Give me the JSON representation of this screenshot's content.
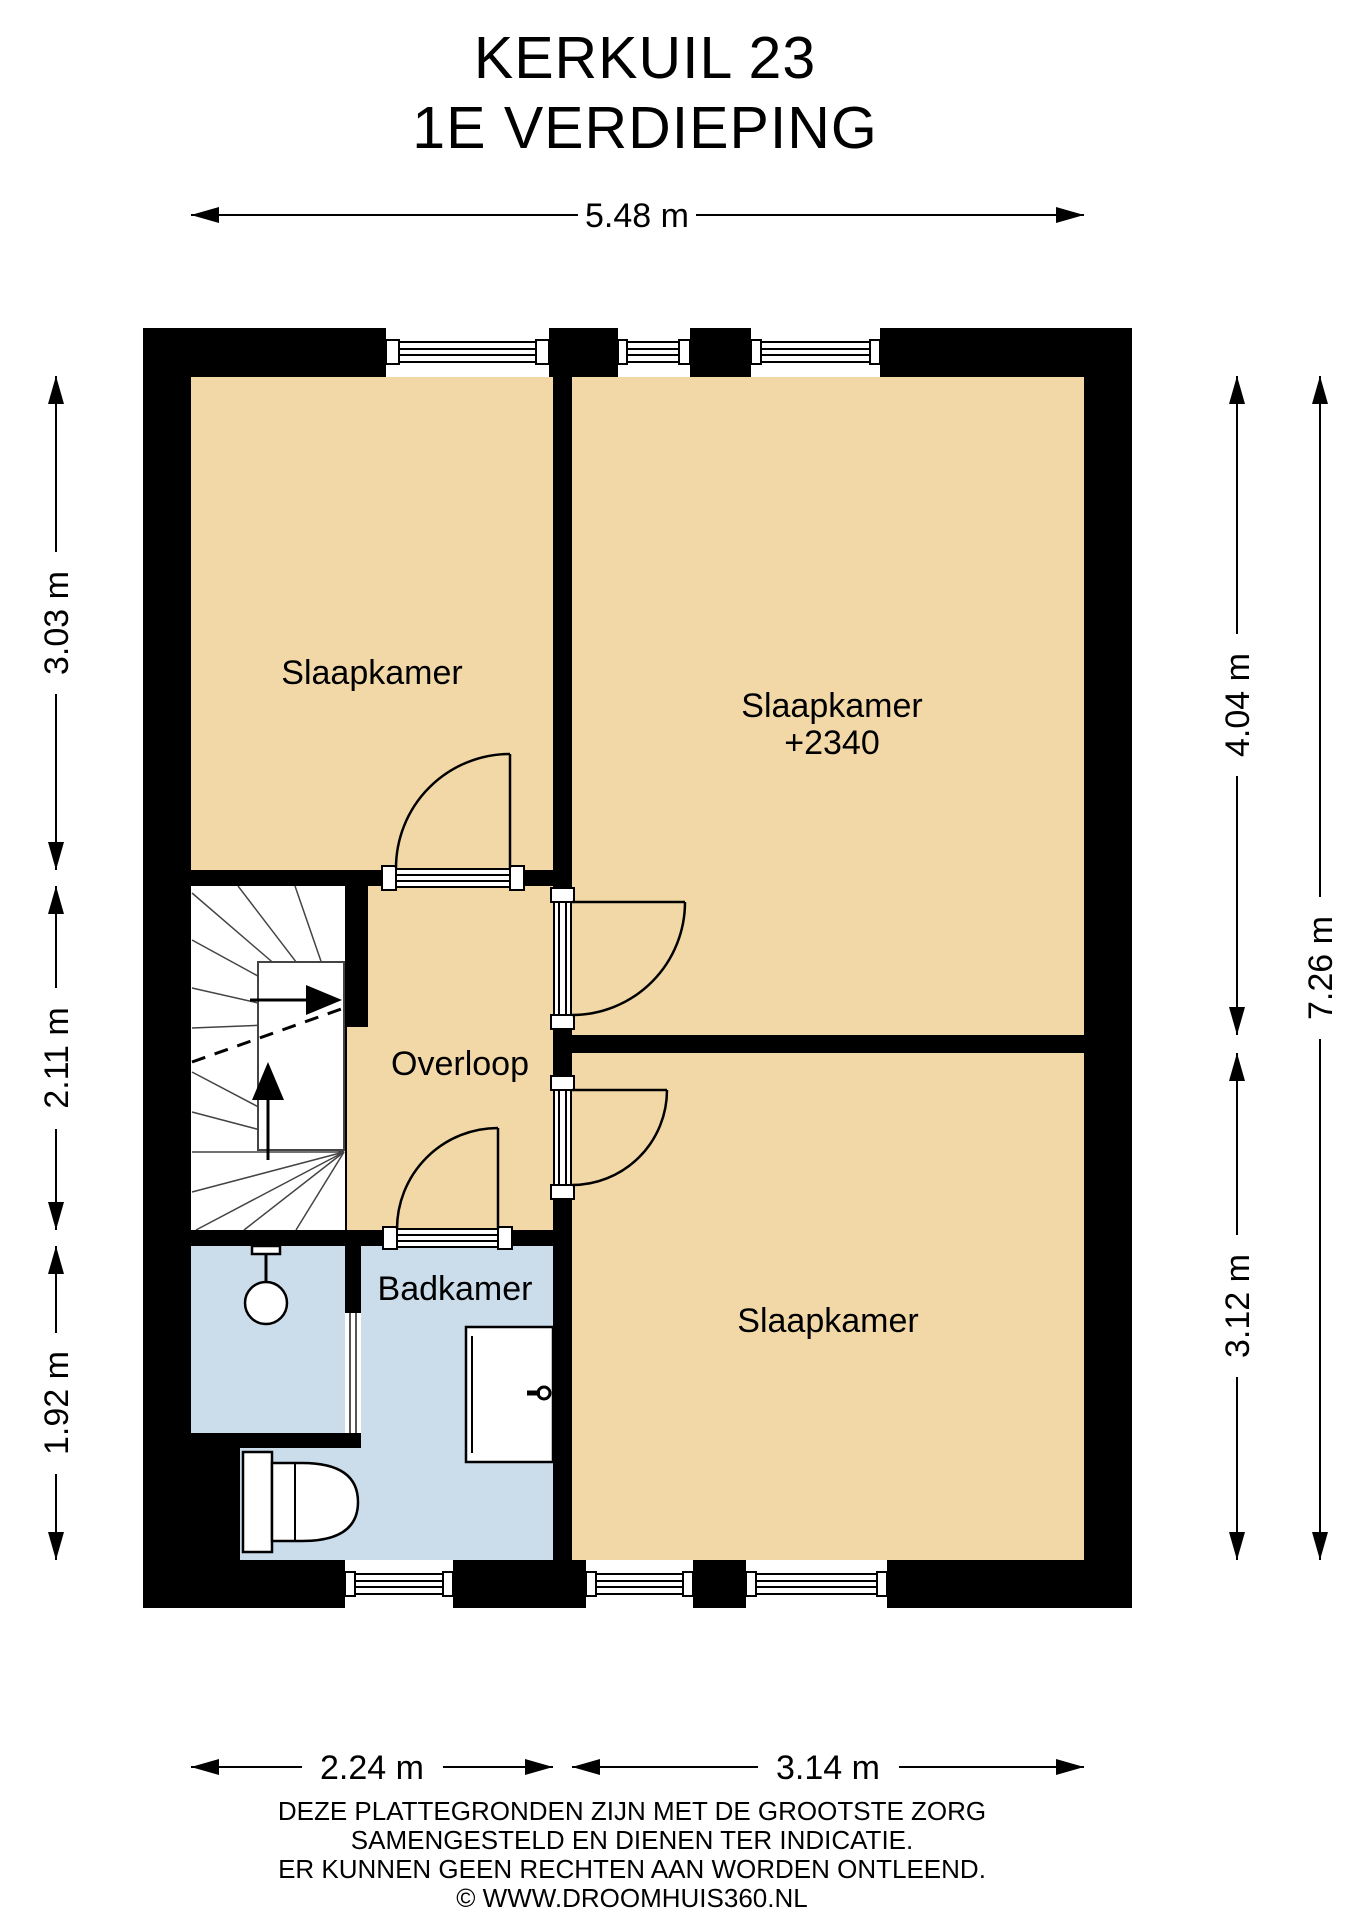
{
  "title": {
    "line1": "KERKUIL 23",
    "line2": "1E VERDIEPING"
  },
  "rooms": {
    "bedroom_top_left": "Slaapkamer",
    "bedroom_right": {
      "name": "Slaapkamer",
      "ceiling": "+2340"
    },
    "landing": "Overloop",
    "bathroom": "Badkamer",
    "bedroom_bottom": "Slaapkamer"
  },
  "dimensions": {
    "width_total": "5.48 m",
    "left_top": "3.03 m",
    "left_middle": "2.11 m",
    "left_bottom": "1.92 m",
    "right_upper": "4.04 m",
    "right_lower": "3.12 m",
    "right_total": "7.26 m",
    "bottom_left": "2.24 m",
    "bottom_right": "3.14 m"
  },
  "footer": {
    "line1": "DEZE PLATTEGRONDEN ZIJN MET DE GROOTSTE ZORG",
    "line2": "SAMENGESTELD EN DIENEN TER INDICATIE.",
    "line3": "ER KUNNEN GEEN RECHTEN AAN WORDEN ONTLEEND.",
    "line4": "© WWW.DROOMHUIS360.NL"
  },
  "colors": {
    "wall": "#000000",
    "floor": "#F2D8A7",
    "bathroom_floor": "#CBDCEA"
  }
}
